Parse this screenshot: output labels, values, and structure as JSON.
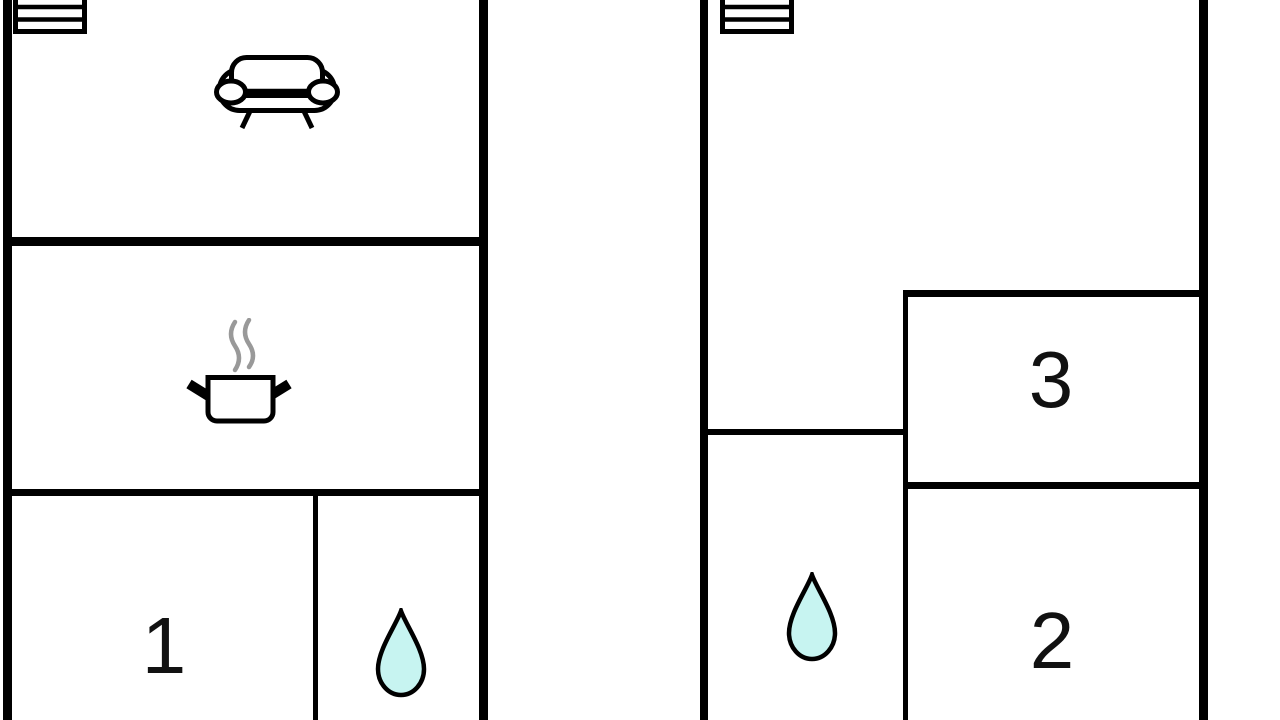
{
  "diagram_type": "floor-plan",
  "colors": {
    "wall": "#000000",
    "bg": "#ffffff",
    "drop": "#c7f4f1",
    "steam": "#999999",
    "label": "#111111"
  },
  "rooms": {
    "room1_label": "1",
    "room2_label": "2",
    "room3_label": "3"
  },
  "icons": {
    "left_plan_stairs": "stairs-icon",
    "left_plan_living": "sofa-icon",
    "left_plan_kitchen": "cooking-pot-icon",
    "left_plan_bathroom": "water-drop-icon",
    "right_plan_stairs": "stairs-icon",
    "right_plan_bathroom": "water-drop-icon"
  }
}
